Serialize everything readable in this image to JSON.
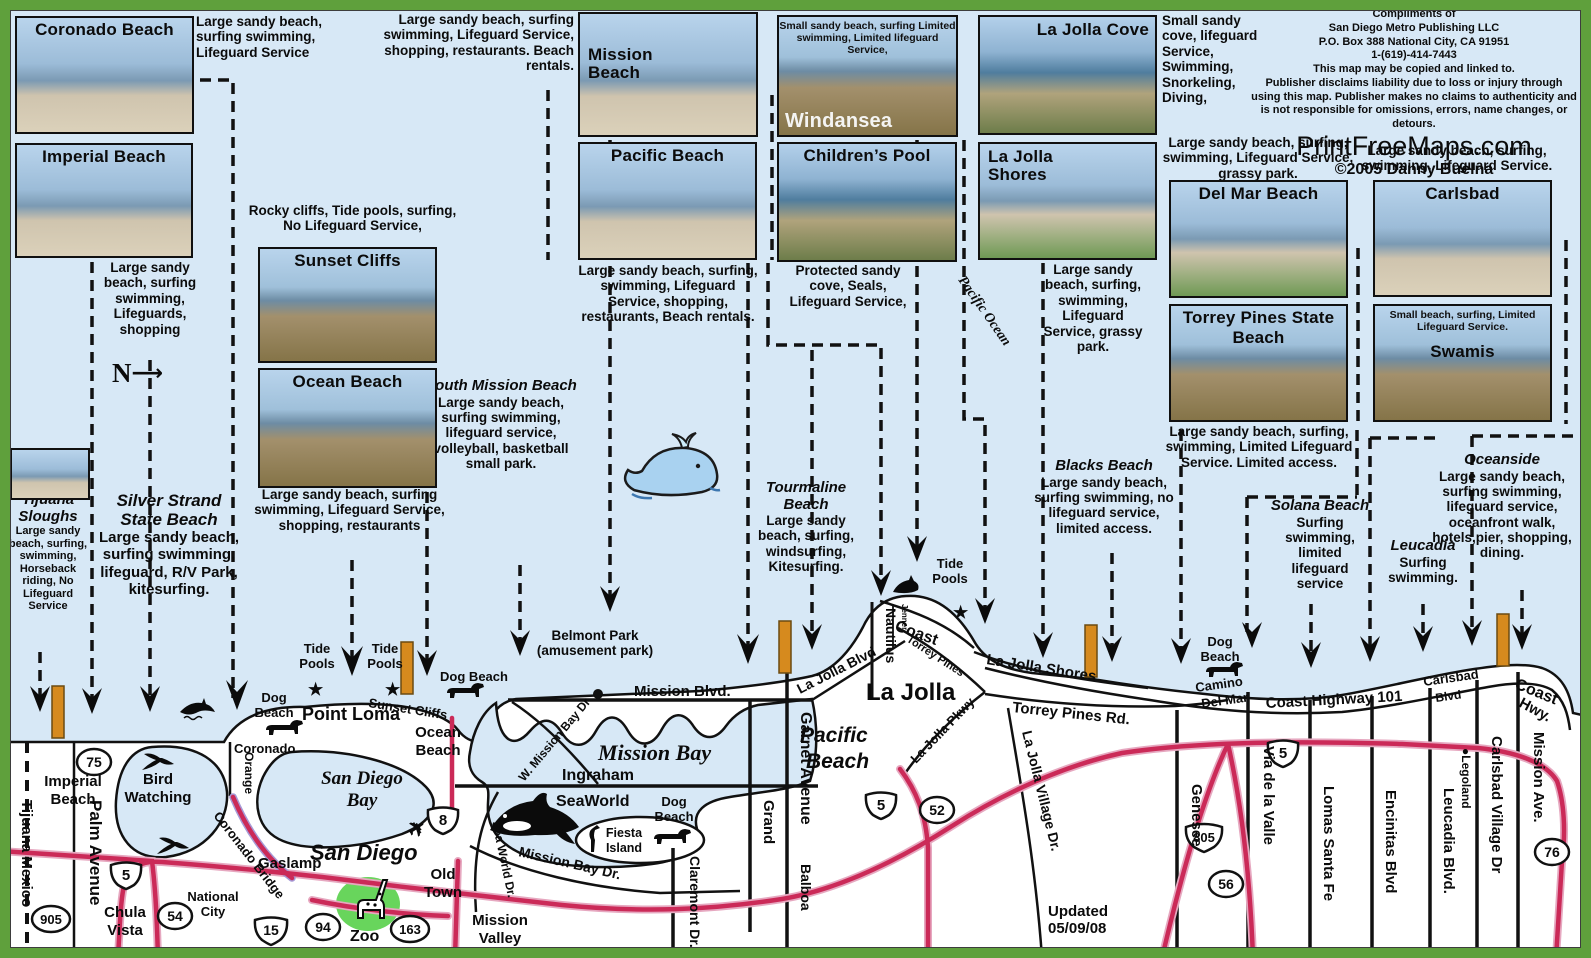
{
  "palette": {
    "frame_green": "#5fa03c",
    "ocean": "#d7e8f6",
    "land": "#ffffff",
    "road_red": "#cb2a58",
    "road_halo": "#e6a8c0",
    "lifeguard_orange": "#d68a1e",
    "whale_blue": "#a9d2f0",
    "zoo_green": "#58d04a"
  },
  "icons": {
    "tide_star": "★",
    "airplane": "✈",
    "north_arrow": "⟶"
  },
  "photos": {
    "coronado": {
      "title": "Coronado Beach"
    },
    "imperial": {
      "title": "Imperial Beach"
    },
    "sunset_cliffs": {
      "title": "Sunset Cliffs"
    },
    "ocean_beach": {
      "title": "Ocean Beach"
    },
    "mission": {
      "title": "Mission Beach"
    },
    "pacific": {
      "title": "Pacific Beach"
    },
    "windansea": {
      "title": "Windansea",
      "overlay": "Small sandy beach, surfing Limited swimming, Limited lifeguard Service,"
    },
    "childrens": {
      "title": "Children’s Pool"
    },
    "lj_cove": {
      "title": "La Jolla Cove"
    },
    "lj_shores": {
      "title": "La Jolla Shores"
    },
    "delmar": {
      "title": "Del Mar Beach"
    },
    "torrey": {
      "title": "Torrey Pines State Beach"
    },
    "carlsbad": {
      "title": "Carlsbad"
    },
    "swamis": {
      "title": "Swamis",
      "overlay": "Small beach, surfing, Limited Lifeguard Service."
    }
  },
  "notes": {
    "coronado_desc": "Large sandy beach, surfing swimming, Lifeguard Service",
    "mission_desc": "Large sandy beach, surfing swimming, Lifeguard Service, shopping, restaurants. Beach rentals.",
    "imperial_desc": "Large sandy beach, surfing swimming, Lifeguards, shopping",
    "rocky_desc": "Rocky cliffs, Tide pools, surfing, No Lifeguard Service,",
    "ocean_beach_desc": "Large sandy beach, surfing swimming, Lifeguard Service, shopping, restaurants",
    "pacific_desc": "Large sandy beach, surfing, swimming, Lifeguard Service, shopping, restaurants, Beach rentals.",
    "childrens_desc": "Protected sandy cove, Seals, Lifeguard Service,",
    "lj_cove_desc": "Small sandy cove, lifeguard Service, Swimming, Snorkeling, Diving,",
    "lj_shores_desc": "Large sandy beach, surfing, swimming, Lifeguard Service, grassy park.",
    "delmar_desc": "Large sandy beach, surfing, swimming, Lifeguard Service, grassy park.",
    "carlsbad_desc": "Large sandy beach, surfing, swimming, Lifeguard Service.",
    "torrey_desc": "Large sandy beach, surfing, swimming, Limited Lifeguard Service. Limited access.",
    "south_mission_title": "South Mission Beach",
    "south_mission_desc": "Large sandy beach, surfing swimming, lifeguard service, volleyball, basketball small park.",
    "tourmaline_title": "Tourmaline Beach",
    "tourmaline_desc": "Large sandy beach, surfing, windsurfing, Kitesurfing.",
    "blacks_title": "Blacks Beach",
    "blacks_desc": "Large sandy beach, surfing swimming, no lifeguard service, limited access.",
    "solana_title": "Solana Beach",
    "solana_desc": "Surfing swimming, limited lifeguard service",
    "leucadia_title": "Leucadia",
    "leucadia_desc": "Surfing swimming.",
    "oceanside_title": "Oceanside",
    "oceanside_desc": "Large sandy beach, surfing swimming, lifeguard service, oceanfront walk, hotels,pier, shopping, dining.",
    "tijuana_title": "Tijuana Sloughs",
    "tijuana_desc": "Large sandy beach, surfing, swimming, Horseback riding, No Lifeguard Service",
    "silver_title": "Silver Strand State Beach",
    "silver_desc": "Large sandy beach, surfing swimming, lifeguard, R/V Park, kitesurfing.",
    "belmont_1": "Belmont Park",
    "belmont_2": "(amusement park)",
    "updated": "Updated 05/09/08",
    "north": "N"
  },
  "publisher": {
    "line1": "Compliments of",
    "line2": "San Diego Metro Publishing  LLC",
    "line3": "P.O. Box 388 National City, CA 91951",
    "line4": "1-(619)-414-7443",
    "line5": "This map may be copied and linked to.",
    "line6": "Publisher disclaims liability due to loss or injury through",
    "line7": "using this map. Publisher makes no claims to authenticity and",
    "line8": "is not responsible for omissions, errors, name changes, or detours.",
    "site": "PrintFreeMaps.com",
    "copyright": "©2005 Danny Buelna"
  },
  "map": {
    "labels": {
      "tijuana_mexico": "Tijuana Mexico",
      "palm_avenue": "Palm Avenue",
      "imperial_beach": [
        "Imperial",
        "Beach"
      ],
      "chula_vista": [
        "Chula",
        "Vista"
      ],
      "national_city": [
        "National",
        "City"
      ],
      "bird_watching": [
        "Bird",
        "Watching"
      ],
      "coronado": "Coronado",
      "orange": "Orange",
      "coronado_bridge": "Coronado Bridge",
      "san_diego_bay": [
        "San Diego",
        "Bay"
      ],
      "gaslamp": "Gaslamp",
      "san_diego": "San Diego",
      "old_town": [
        "Old",
        "Town"
      ],
      "zoo": "Zoo",
      "mission_valley": [
        "Mission",
        "Valley"
      ],
      "point_loma": "Point Loma",
      "sunset_cliffs": "Sunset Cliffs",
      "ocean_beach": [
        "Ocean",
        "Beach"
      ],
      "dog_beach": [
        "Dog",
        "Beach"
      ],
      "dog_beach_line": "Dog Beach",
      "tide_pools": [
        "Tide",
        "Pools"
      ],
      "mission_blvd": "Mission Blvd.",
      "mission_bay": "Mission Bay",
      "w_mission_bay": "W. Mission Bay Dr",
      "ingraham": "Ingraham",
      "seaworld": "SeaWorld",
      "fiesta_island": [
        "Fiesta",
        "Island"
      ],
      "sea_world_dr": "Sea World Dr.",
      "mission_bay_dr": "Mission Bay Dr.",
      "grand": "Grand",
      "garnet": "Garnet Avenue",
      "balboa": "Balboa",
      "claremont": "Claremont Dr.",
      "la_jolla": "La Jolla",
      "pacific_beach": [
        "Pacific",
        "Beach"
      ],
      "la_jolla_blvd": "La Jolla Blvd",
      "nautilus": "Nautilus",
      "jenner": "Jenner",
      "coast": "Coast",
      "torrey_pines": "Torrey Pines",
      "la_jolla_pkwy": "La Jolla Pkwy",
      "torrey_pines_rd": "Torrey Pines Rd.",
      "la_jolla_shores": "La Jolla Shores",
      "la_jolla_village": "La Jolla Village Dr.",
      "genesee": "Genesee",
      "camino": [
        "Camino",
        "Del Mar"
      ],
      "via_valle": "Via de la Valle",
      "coast_hwy_101": "Coast Highway  101",
      "carlsbad_blvd": [
        "Carlsbad",
        "Blvd"
      ],
      "coast_hwy": [
        "Coast",
        "Hwy."
      ],
      "lomas": "Lomas Santa Fe",
      "encinitas": "Encinitas Blvd",
      "leucadia_blvd": "Leucadia Blvd.",
      "legoland": "●Legoland",
      "carlsbad_village": "Carlsbad Village Dr",
      "mission_ave": "Mission Ave.",
      "pacific_ocean": "Pacific Ocean"
    },
    "shields": {
      "i5": "5",
      "i8": "8",
      "i15": "15",
      "i805": "805",
      "s75": "75",
      "s905": "905",
      "s54": "54",
      "s94": "94",
      "s163": "163",
      "s52": "52",
      "s56": "56",
      "s76": "76"
    }
  }
}
